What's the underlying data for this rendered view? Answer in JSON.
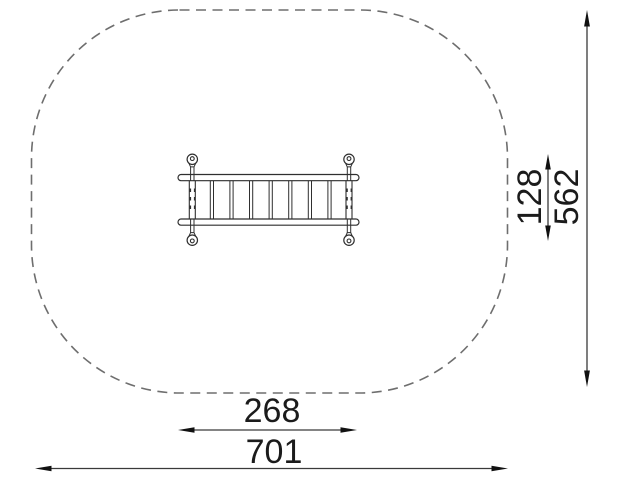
{
  "diagram": {
    "title": "playground item top-view dimension drawing",
    "dims": {
      "item_width": "268",
      "zone_width": "701",
      "item_depth": "128",
      "zone_depth": "562"
    },
    "equipment": {
      "name": "horizontal-ladder-top-view",
      "rung_count": 7,
      "anchor_count": 4
    },
    "colors": {
      "outline": "#2f2f2f",
      "dimension_line": "#3a3a3a",
      "arrowhead": "#111111",
      "boundary_dash": "#6e6e6e",
      "text": "#1b1b1b",
      "background": "#ffffff"
    }
  }
}
